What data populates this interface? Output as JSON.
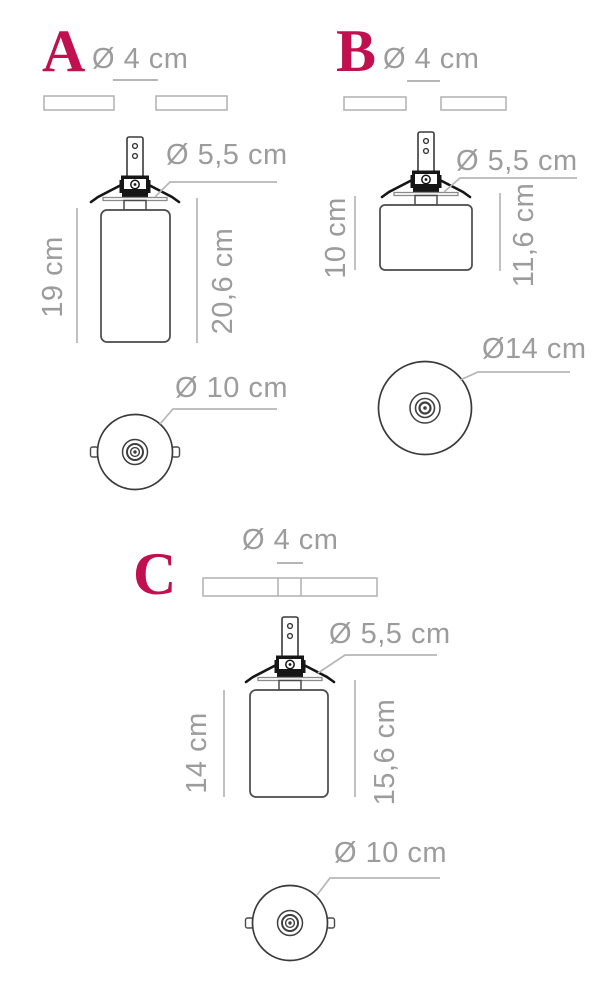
{
  "title": "Ceiling lamp dimension diagram",
  "colors": {
    "accent": "#c11050",
    "label_gray": "#9c9c9c",
    "dim_line_gray": "#b6b6b6",
    "drawing_stroke": "#4a4a4a",
    "bracket_black": "#161616"
  },
  "sections": [
    {
      "letter": "A",
      "top_diameter": "Ø 4 cm",
      "holder_diameter": "Ø 5,5 cm",
      "height_inner": "19 cm",
      "height_outer": "20,6 cm",
      "bottom_diameter": "Ø 10 cm"
    },
    {
      "letter": "B",
      "top_diameter": "Ø 4 cm",
      "holder_diameter": "Ø 5,5 cm",
      "height_inner": "10 cm",
      "height_outer": "11,6 cm",
      "bottom_diameter": "Ø14 cm"
    },
    {
      "letter": "C",
      "top_diameter": "Ø 4 cm",
      "holder_diameter": "Ø 5,5 cm",
      "height_inner": "14 cm",
      "height_outer": "15,6 cm",
      "bottom_diameter": "Ø 10 cm"
    }
  ]
}
